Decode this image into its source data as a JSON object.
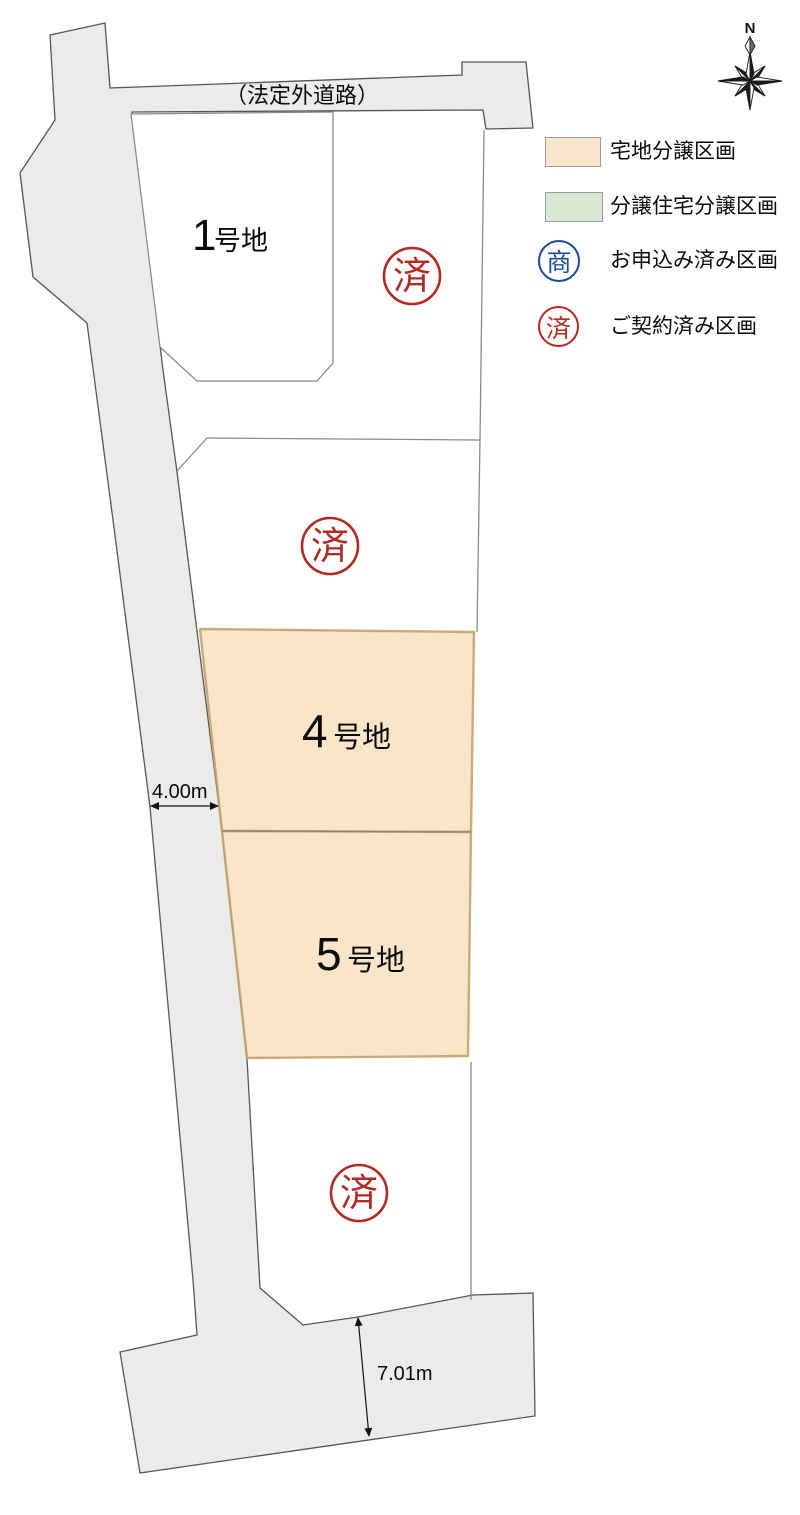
{
  "compass": {
    "north": "N"
  },
  "road": {
    "label": "（法定外道路）"
  },
  "plots": {
    "p1": {
      "number": "1",
      "suffix": "号地",
      "status": "available"
    },
    "p2_sold": {
      "stamp": "済"
    },
    "p3_sold": {
      "stamp": "済"
    },
    "p4": {
      "number": "4",
      "suffix": "号地",
      "status": "available"
    },
    "p5": {
      "number": "5",
      "suffix": "号地",
      "status": "available"
    },
    "p6_sold": {
      "stamp": "済"
    }
  },
  "stamps": {
    "sold": "済",
    "applied": "商"
  },
  "dimensions": {
    "road_width": "4.00m",
    "frontage": "7.01m"
  },
  "legend": {
    "items": [
      {
        "label": "宅地分譲区画",
        "color": "#FBE7CB"
      },
      {
        "label": "分譲住宅分譲区画",
        "color": "#D8E8D5"
      },
      {
        "stamp": "商",
        "label": "お申込み済み区画",
        "color": "#1C4B9E"
      },
      {
        "stamp": "済",
        "label": "ご契約済み区画",
        "color": "#B22A22"
      }
    ]
  },
  "colors": {
    "lot_fill": "#F9E5C7",
    "lot_edge": "#C29E66",
    "road_fill": "#EBEBEB",
    "road_edge": "#565656",
    "plot_line": "#8A8A8A",
    "sold_red": "#B22A22",
    "applied_blue": "#1C4B9E"
  }
}
